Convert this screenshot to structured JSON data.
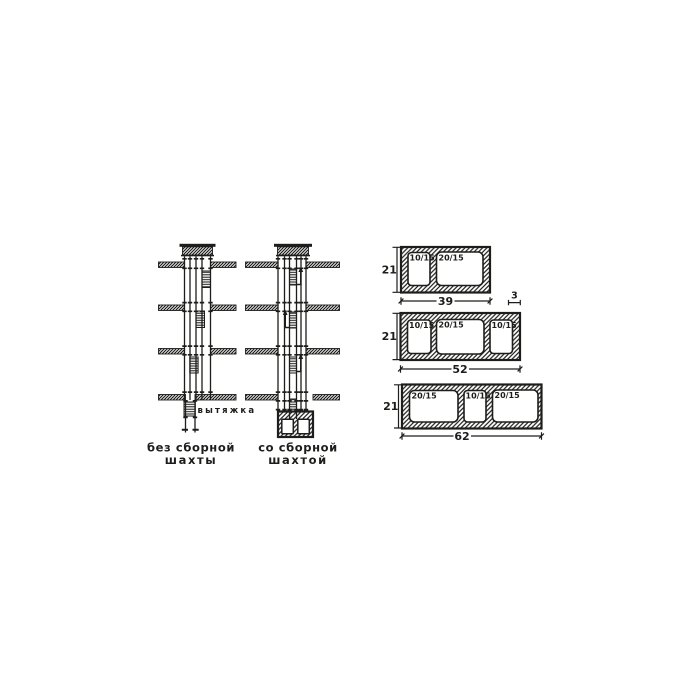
{
  "figure": {
    "ink_color": "#1d1d1b",
    "background_color": "#ffffff",
    "shafts": {
      "exhaust_label": "вытяжка",
      "without_collector": {
        "caption_line1": "без сборной",
        "caption_line2": "шахты"
      },
      "with_collector": {
        "caption_line1": "со сборной",
        "caption_line2": "шахтой"
      }
    },
    "blocks": [
      {
        "height": "21",
        "width": "39",
        "wall_thickness": "3",
        "openings": [
          "10/15",
          "20/15"
        ]
      },
      {
        "height": "21",
        "width": "52",
        "openings": [
          "10/15",
          "20/15",
          "10/15"
        ]
      },
      {
        "height": "21",
        "width": "62",
        "openings": [
          "20/15",
          "10/15",
          "20/15"
        ]
      }
    ]
  }
}
